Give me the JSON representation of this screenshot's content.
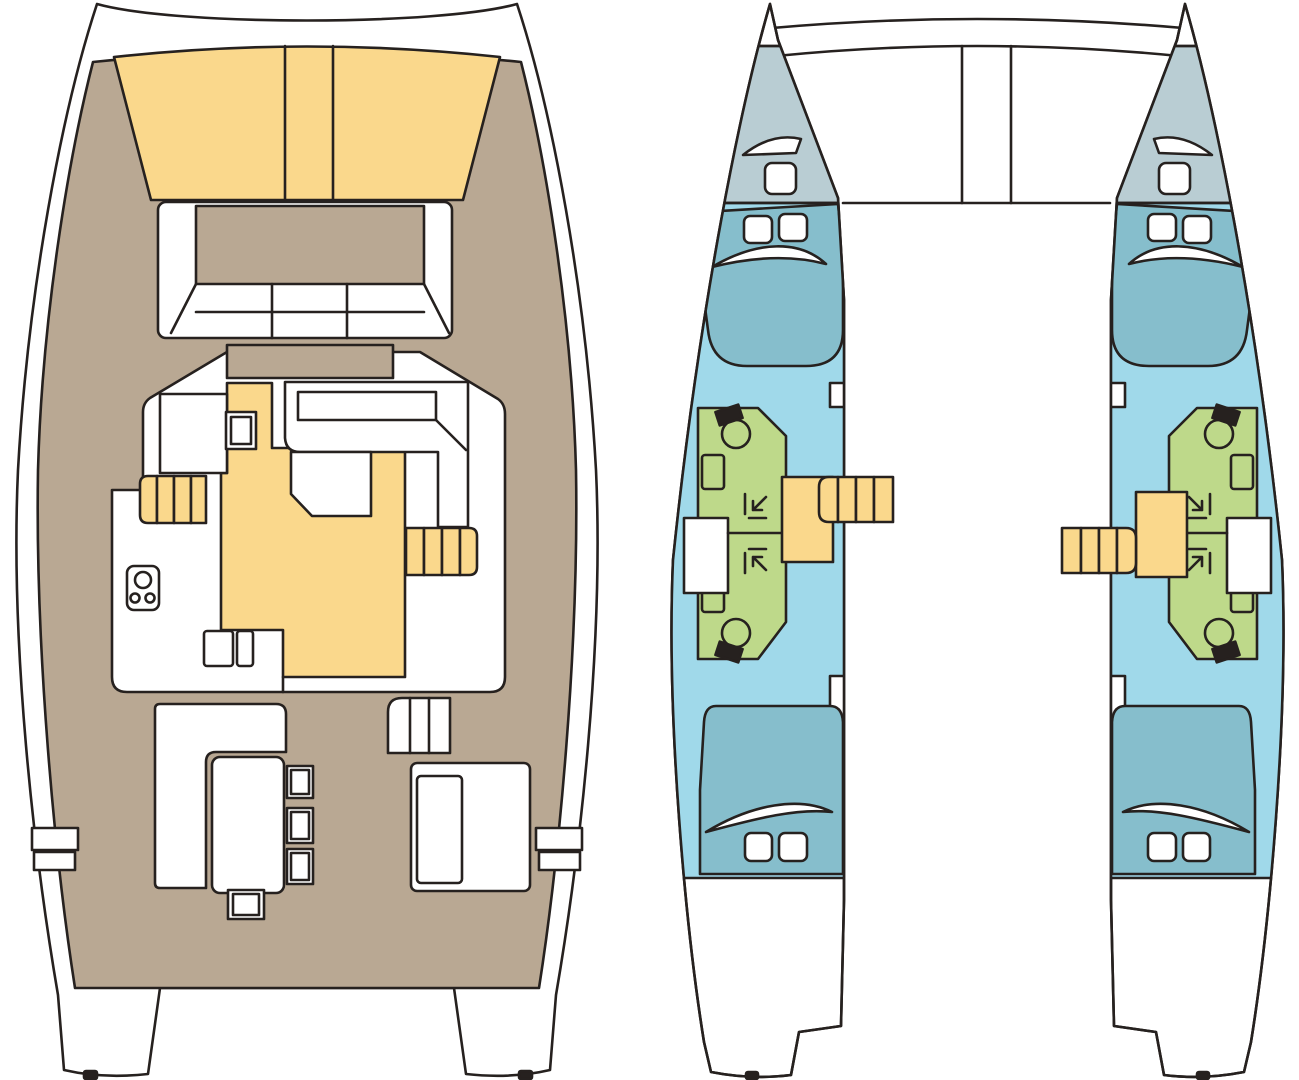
{
  "diagram": {
    "type": "floor-plan",
    "subject": "catamaran-yacht-layout",
    "views": [
      {
        "id": "deck-plan",
        "description": "main deck: bow sunpads, foredeck lounge, saloon with galley, aft cockpit, twin transoms"
      },
      {
        "id": "hull-plan",
        "description": "twin hulls: forepeak lockers, forward double cabins, central bathrooms with shower and toilet, companionway stairs, aft double cabins"
      }
    ]
  },
  "colors": {
    "outline": "#26211f",
    "white": "#ffffff",
    "deck_tan": "#b9a893",
    "pad_yellow": "#fad88c",
    "floor_blue": "#a0d9ea",
    "bed_teal": "#86becc",
    "forepeak_gray": "#b9cdd3",
    "bath_green": "#bed98a"
  },
  "deck_plan": {
    "regions": [
      {
        "name": "bow-sunpad-port"
      },
      {
        "name": "bow-sunpad-center"
      },
      {
        "name": "bow-sunpad-starboard"
      },
      {
        "name": "foredeck-lounge"
      },
      {
        "name": "saloon"
      },
      {
        "name": "galley-seating"
      },
      {
        "name": "galley-counter"
      },
      {
        "name": "nav-counter"
      },
      {
        "name": "saloon-table"
      },
      {
        "name": "stairs-port-hull"
      },
      {
        "name": "stairs-starboard-hull"
      },
      {
        "name": "stove"
      },
      {
        "name": "cockpit"
      },
      {
        "name": "cockpit-sofa"
      },
      {
        "name": "cockpit-table"
      },
      {
        "name": "cockpit-stools",
        "count": 4
      },
      {
        "name": "helm-steps"
      },
      {
        "name": "cockpit-bench"
      },
      {
        "name": "boarding-steps",
        "count": 4
      },
      {
        "name": "swim-platform-port"
      },
      {
        "name": "swim-platform-starboard"
      }
    ]
  },
  "hull_plan": {
    "per_hull_regions": [
      {
        "name": "forepeak-locker"
      },
      {
        "name": "bow-hatch"
      },
      {
        "name": "deck-hatch"
      },
      {
        "name": "forward-cabin",
        "berth": "double"
      },
      {
        "name": "bathroom-forward",
        "fixtures": [
          "toilet",
          "sink",
          "shower"
        ]
      },
      {
        "name": "bathroom-aft",
        "fixtures": [
          "toilet",
          "sink",
          "shower"
        ]
      },
      {
        "name": "companionway-stairs"
      },
      {
        "name": "aft-cabin",
        "berth": "double"
      }
    ],
    "hulls": [
      "port",
      "starboard"
    ],
    "structure": [
      "crossbeam",
      "bridgedeck",
      "mast-beam"
    ]
  }
}
